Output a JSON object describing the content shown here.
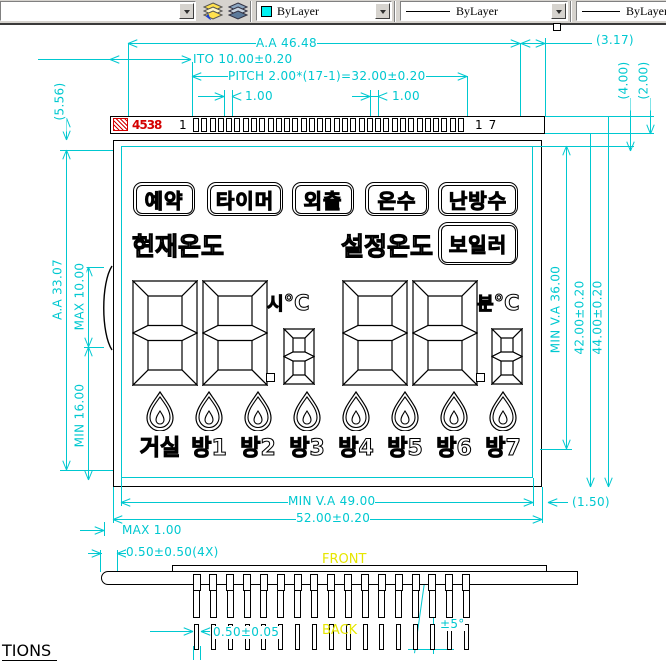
{
  "toolbar": {
    "color_control": {
      "label": "ByLayer",
      "swatch_color": "#00F0F0"
    },
    "linetype_control": {
      "label": "ByLayer"
    },
    "lineweight_control": {
      "label": "ByLayer"
    }
  },
  "lcd": {
    "part_number": "4538",
    "pin_first": "1",
    "pin_last": "17",
    "pad_count": 33,
    "buttons": [
      "예약",
      "타이머",
      "외출",
      "온수",
      "난방수"
    ],
    "current_temp_label": "현재온도",
    "set_temp_label": "설정온도",
    "boiler_label": "보일러",
    "hour_unit": "시",
    "minute_unit": "분",
    "degree_unit": "°C",
    "digits_large": [
      "8",
      "8",
      "8",
      "8"
    ],
    "digits_small": [
      "8",
      "8"
    ],
    "rooms": [
      "거실",
      "방1",
      "방2",
      "방3",
      "방4",
      "방5",
      "방6",
      "방7"
    ]
  },
  "dimensions": {
    "aa_width": "A.A 46.48",
    "ito": "ITO 10.00±0.20",
    "pitch": "PITCH 2.00*(17-1)=32.00±0.20",
    "pad_width_a": "1.00",
    "pad_width_b": "1.00",
    "gap_317": "(3.17)",
    "gap_400": "(4.00)",
    "gap_200": "(2.00)",
    "gap_556": "(5.56)",
    "aa_height": "A.A 33.07",
    "max_bump": "MAX 10.00",
    "min_ledge": "MIN 16.00",
    "min_va_height": "MIN V.A 36.00",
    "total_height_42": "42.00±0.20",
    "total_height_44": "44.00±0.20",
    "gap_150": "(1.50)",
    "min_va_width": "MIN V.A 49.00",
    "total_width_52": "52.00±0.20",
    "max_offset": "MAX 1.00",
    "pin_offset": "0.50±0.50(4X)",
    "pin_width": "0.50±0.05",
    "pin_angle": "±5°"
  },
  "side_view": {
    "front_label": "FRONT",
    "back_label": "BACK",
    "pin_count": 17
  },
  "footer": {
    "sheet_text": "TIONS"
  },
  "colors": {
    "dimension": "#00c8d0",
    "highlight_red": "#d40000",
    "view_label_yellow": "#e6e600"
  }
}
